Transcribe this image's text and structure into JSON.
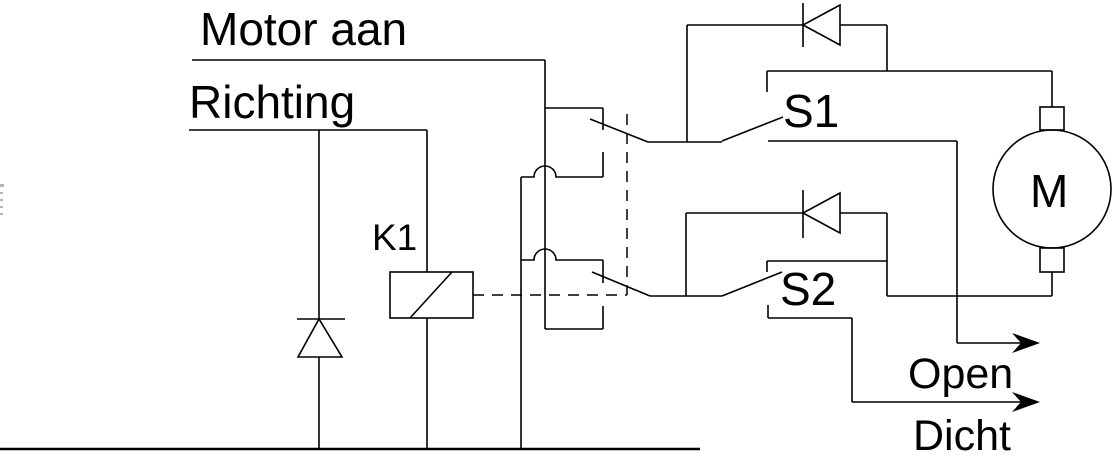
{
  "labels": {
    "motor_aan": "Motor aan",
    "richting": "Richting",
    "relay": "K1",
    "switch_1": "S1",
    "switch_2": "S2",
    "motor": "M",
    "output_open": "Open",
    "output_dicht": "Dicht"
  },
  "colors": {
    "line": "#000000",
    "background": "#ffffff",
    "text": "#000000"
  },
  "symbols": [
    "relay-coil-symbol",
    "changeover-contact-upper",
    "changeover-contact-lower",
    "mechanical-linkage-dashed",
    "freewheel-diode",
    "diode-parallel-s1",
    "diode-parallel-s2",
    "limit-switch-s1",
    "limit-switch-s2",
    "dc-motor",
    "signal-arrow-open",
    "signal-arrow-dicht",
    "ground-rail"
  ]
}
